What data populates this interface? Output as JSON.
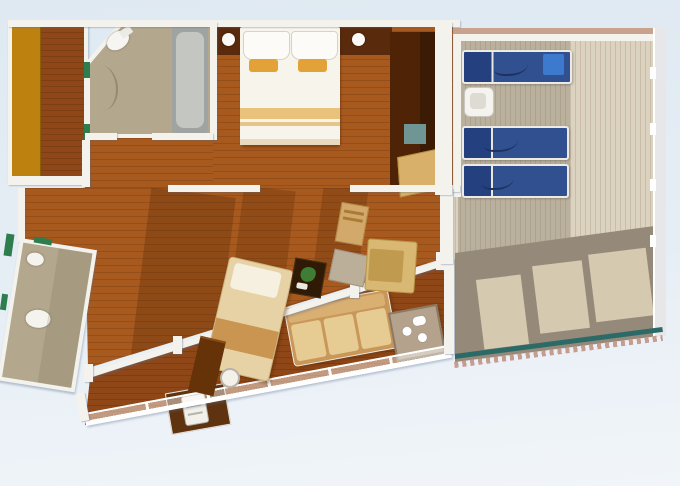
{
  "title": "cruise-suite-floor-plan",
  "canvas": {
    "width": 680,
    "height": 486
  },
  "palette": {
    "bg-top": "#dfe9f1",
    "bg-mid": "#e6eef5",
    "bg-bottom": "#f1f5f9",
    "wall": "#f3f2ed",
    "wood-base": "#a85a1e",
    "wood-dark": "#8f4717",
    "floor-light": "#d08а2a",
    "floor-shadow": "#5e2b09",
    "bath-floor": "#b3a78d",
    "tub-outer": "#9fa3a1",
    "tub-inner": "#c4c6c2",
    "door-marker": "#2e7d4f",
    "wardrobe-amber": "#bd8110",
    "closet-dark": "#4f2406",
    "headboard": "#5a2a0d",
    "bed-linen": "#f7f4ec",
    "bed-accent": "#e2a238",
    "bed-stripe": "#e9c27c",
    "deck-plank": "#dbd2bf",
    "deck-shadow": "#95897a",
    "deck-window-light": "#d5c9b0",
    "deck-top-wall": "#c9a28d",
    "lounger-blue": "#30508f",
    "lounger-cushion": "#3d79cf",
    "teal-edge": "#2c6a67",
    "sawtooth": "#c69b90",
    "teal-mat": "#6f9694",
    "sofa-frame": "#c9975a",
    "sofa-cushion": "#e6cb92",
    "chaise": "#e7d2a6",
    "plant": "#3f7d35"
  },
  "plan": {
    "type": "cruise-ship-suite-floor-plan",
    "rooms": [
      {
        "name": "walk-in-wardrobe",
        "features": [
          "amber-wardrobe-strip",
          "wood-floor"
        ]
      },
      {
        "name": "master-bathroom",
        "features": [
          "toilet",
          "bathtub",
          "vanity-curve",
          "door-markers"
        ]
      },
      {
        "name": "master-bedroom",
        "features": [
          "double-bed",
          "two-pillows",
          "two-orange-accent-pillows",
          "bed-stripe",
          "headboard-wall",
          "two-round-lamps",
          "dark-closet",
          "teal-mat",
          "vanity-desk"
        ]
      },
      {
        "name": "living-room",
        "features": [
          "chaise-longue",
          "tv-cabinet",
          "round-lamp",
          "plant-side-table",
          "gray-ottoman",
          "armchair",
          "dining-chair",
          "sunlight-patches",
          "cast-shadows"
        ]
      },
      {
        "name": "second-bathroom-angled",
        "features": [
          "toilet",
          "sink",
          "door-markers"
        ]
      },
      {
        "name": "balcony",
        "features": [
          "outdoor-sofa",
          "tea-table-with-cups",
          "minibar-alcove",
          "glass-railing",
          "railing-posts"
        ]
      },
      {
        "name": "private-sun-deck",
        "features": [
          "sun-lounger",
          "sun-lounger",
          "sun-lounger",
          "white-side-table",
          "cabin-shadow",
          "railing-shadow-with-light-windows",
          "teal-edge-strip",
          "sawtooth-edge"
        ]
      }
    ],
    "sun_loungers_count": 3,
    "orientation": "bottom-edge-slanted"
  }
}
